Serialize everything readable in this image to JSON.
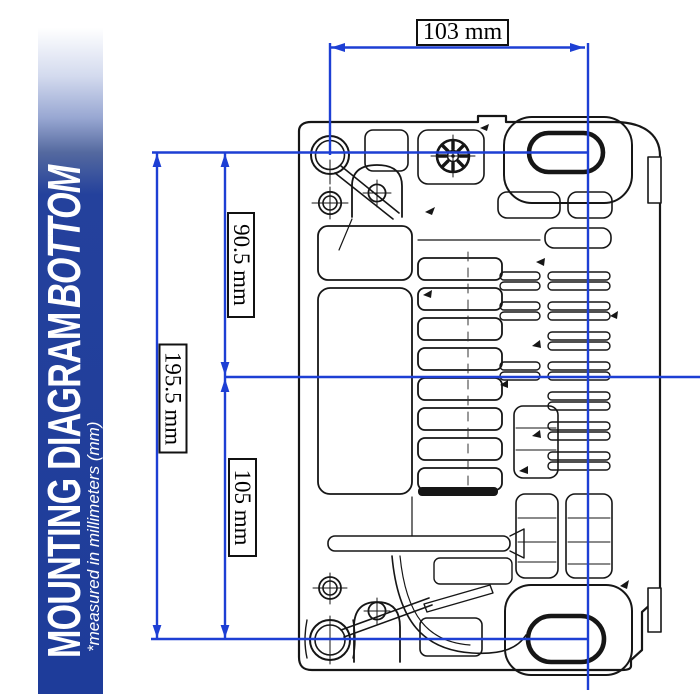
{
  "page": {
    "background": "#ffffff"
  },
  "sidebar": {
    "title": "MOUNTING DIAGRAM",
    "title_emphasis": "BOTTOM",
    "subtitle": "*measured in millimeters (mm)",
    "colors": {
      "banner_blue": "#1e3c9a",
      "text": "#ffffff"
    }
  },
  "diagram": {
    "type": "technical-mounting-diagram",
    "view": "bottom",
    "units": "mm",
    "colors": {
      "dimension_blue": "#1d3fd4",
      "line_black": "#161616"
    },
    "dimensions": [
      {
        "name": "mounting-width-top",
        "label": "103 mm",
        "value": 103,
        "unit": "mm",
        "orientation": "horizontal"
      },
      {
        "name": "upper-mount-height",
        "label": "90.5 mm",
        "value": 90.5,
        "unit": "mm",
        "orientation": "vertical"
      },
      {
        "name": "total-mount-height",
        "label": "195.5 mm",
        "value": 195.5,
        "unit": "mm",
        "orientation": "vertical"
      },
      {
        "name": "lower-mount-height",
        "label": "105 mm",
        "value": 105,
        "unit": "mm",
        "orientation": "vertical"
      }
    ]
  }
}
